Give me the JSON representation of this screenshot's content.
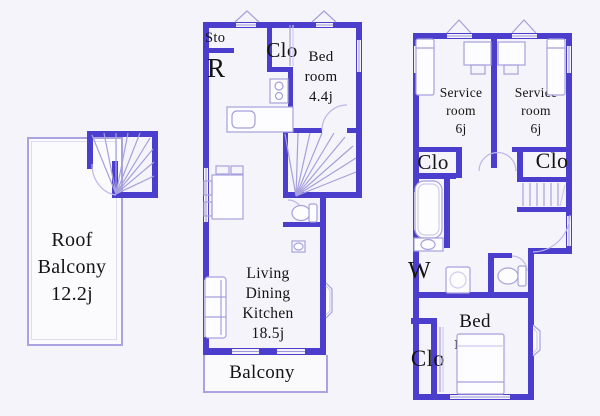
{
  "colors": {
    "wall": "#4b3ecd",
    "thin_line": "#a6a0dc",
    "window_line": "#9c96d8",
    "text": "#141414",
    "background": "#f5f4fa"
  },
  "roof_unit": {
    "label_lines": [
      "Roof",
      "Balcony",
      "12.2j"
    ]
  },
  "middle_unit": {
    "storage_label": "Sto",
    "fridge_label": "R",
    "closet_label": "Clo",
    "bedroom_lines": [
      "Bed",
      "room",
      "4.4j"
    ],
    "ldk_lines": [
      "Living",
      "Dining",
      "Kitchen",
      "18.5j"
    ],
    "balcony_label": "Balcony"
  },
  "right_unit": {
    "service_left_lines": [
      "Service",
      "room",
      "6j"
    ],
    "service_right_lines": [
      "Service",
      "room",
      "6j"
    ],
    "closet_left_label": "Clo",
    "closet_right_label": "Clo",
    "laundry_label": "W",
    "bedroom_lines": [
      "Bed",
      "room",
      "7j"
    ],
    "bedroom_closet_label": "Clo"
  }
}
